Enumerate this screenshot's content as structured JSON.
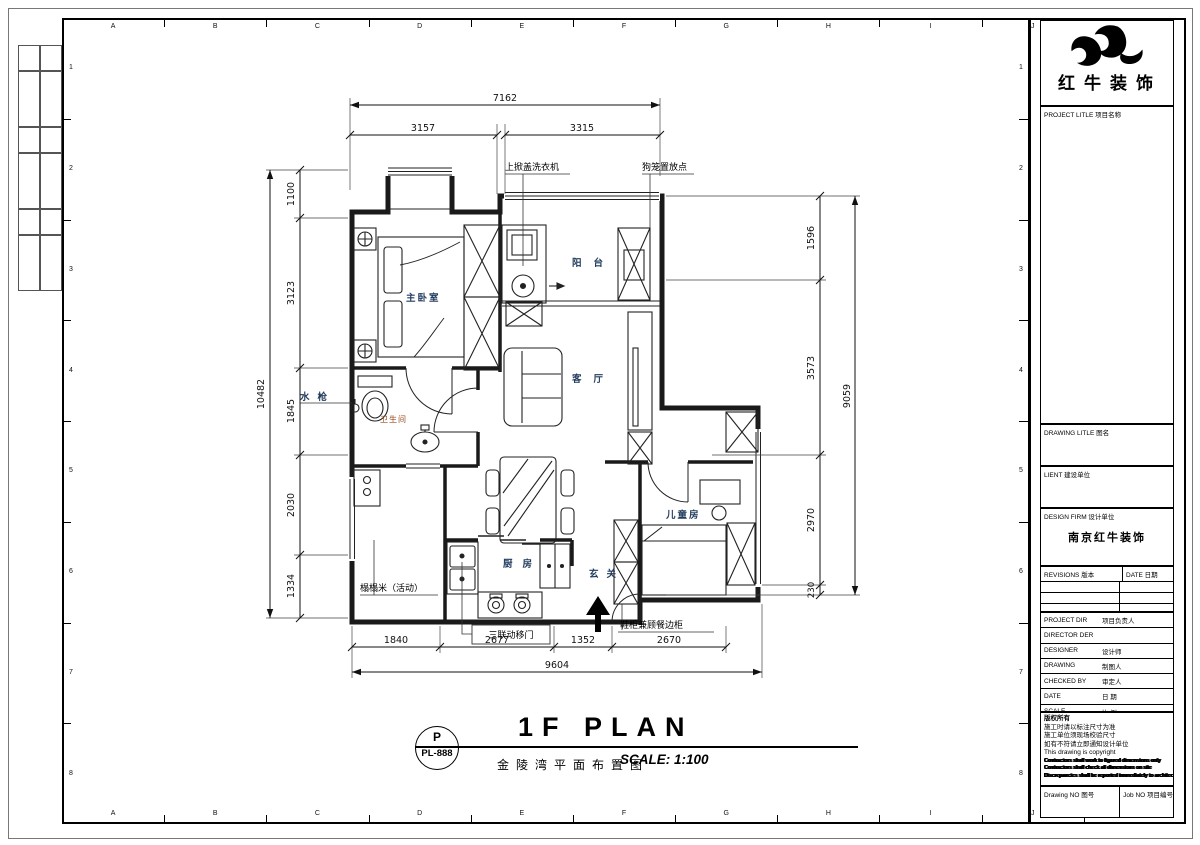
{
  "sheet": {
    "grid_letters": [
      "A",
      "B",
      "C",
      "D",
      "E",
      "F",
      "G",
      "H",
      "I",
      "J",
      "K"
    ],
    "grid_numbers": [
      "1",
      "2",
      "3",
      "4",
      "5",
      "6",
      "7",
      "8"
    ]
  },
  "plan": {
    "rooms": {
      "master_bedroom": "主卧室",
      "balcony": "阳台",
      "living_room": "客厅",
      "bathroom": "卫生间",
      "kids_room": "儿童房",
      "kitchen": "厨房",
      "entry": "玄关"
    },
    "annotations": {
      "washer": "上掀盖洗衣机",
      "dog_cage": "狗笼置放点",
      "water_gun": "水枪",
      "tatami": "榻榻米（活动）",
      "sliding_door": "三联动移门",
      "shoe_cabinet": "鞋柜兼顾餐边柜"
    }
  },
  "dims": {
    "top": {
      "total": "7162",
      "segments": [
        "3157",
        "3315"
      ]
    },
    "left": {
      "total": "10482",
      "segments": [
        "1100",
        "3123",
        "1845",
        "2030",
        "1334"
      ]
    },
    "right": {
      "total": "9059",
      "segments": [
        "1596",
        "3573",
        "2970",
        "230"
      ]
    },
    "bottom": {
      "total": "9604",
      "segments": [
        "1840",
        "2677",
        "1352",
        "2670"
      ]
    }
  },
  "title": {
    "tag_letter": "P",
    "tag_code": "PL-888",
    "name_en": "1F PLAN",
    "name_cn": "金陵湾平面布置图",
    "scale": "SCALE: 1:100"
  },
  "titleblock": {
    "logo_text": "红牛装饰",
    "project_title": "PROJECT LITLE  项目名称",
    "drawing_title": "DRAWING LITLE  图名",
    "client": "LIENT  建设单位",
    "design_firm_label": "DESIGN FIRM  设计单位",
    "design_firm_value": "南京红牛装饰",
    "revisions_label": "REVISIONS  版本",
    "date_col_label": "DATE  日期",
    "rows": [
      {
        "label": "PROJECT DIR",
        "cn": "项目负责人"
      },
      {
        "label": "DIRECTOR DER",
        "cn": ""
      },
      {
        "label": "DESIGNER",
        "cn": "设计师"
      },
      {
        "label": "DRAWING",
        "cn": "制图人"
      },
      {
        "label": "CHECKED BY",
        "cn": "审定人"
      },
      {
        "label": "DATE",
        "cn": "日 期"
      },
      {
        "label": "SCALE",
        "cn": "比 例"
      }
    ],
    "notes": {
      "copyright_cn": "版权所有",
      "lines_cn": [
        "施工时请以标注尺寸为准",
        "施工单位须现场校验尺寸",
        "如有不符请立即通知设计单位"
      ],
      "copyright_en": "This drawing is copyright",
      "lines_en": [
        "Contractors shall work to figured dimensions only",
        "Contractors shall check all dimensions on site",
        "Discrepancies shall be reported immediately to architects"
      ]
    },
    "drawing_no_label": "Drawing NO  图号",
    "job_no_label": "Job NO  项目编号"
  },
  "colors": {
    "line": "#1a1a1a",
    "room_label": "#1f3a5c",
    "bathroom_label": "#9a4d1e"
  }
}
